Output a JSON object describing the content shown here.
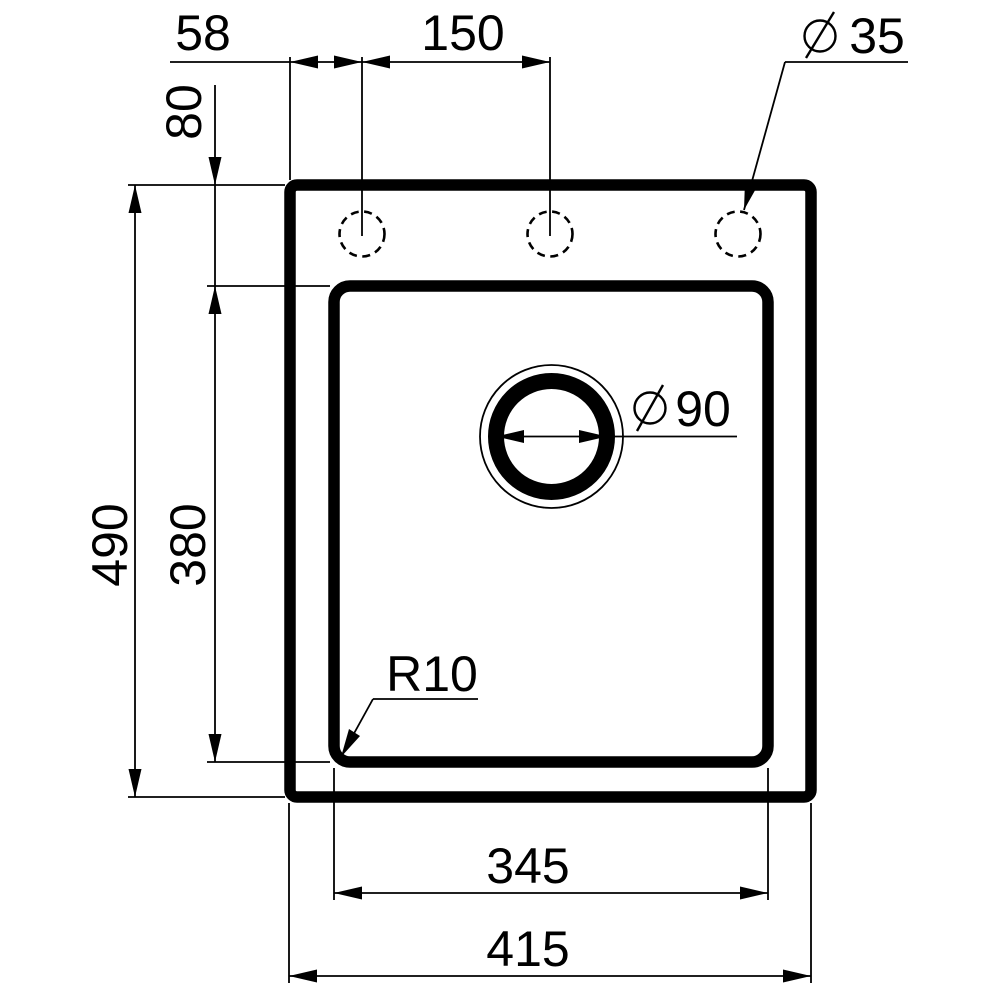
{
  "page": {
    "background": "#ffffff",
    "ink": "#000000",
    "description_labels_visible": [
      "58",
      "150",
      "35",
      "80",
      "90",
      "490",
      "380",
      "R10",
      "345",
      "415"
    ]
  },
  "labels": {
    "dim_58": "58",
    "dim_150": "150",
    "dia_35": "35",
    "dim_80": "80",
    "dia_90": "90",
    "dim_490": "490",
    "dim_380": "380",
    "radius_r10": "R10",
    "dim_345": "345",
    "dim_415": "415"
  },
  "dimensions": [
    {
      "value": 58,
      "type": "linear",
      "orientation": "horizontal",
      "measures": "rim left edge to first faucet hole center"
    },
    {
      "value": 150,
      "type": "linear",
      "orientation": "horizontal",
      "measures": "spacing between faucet hole centers"
    },
    {
      "value": 35,
      "type": "diameter",
      "orientation": "leader",
      "measures": "faucet hole diameter"
    },
    {
      "value": 80,
      "type": "linear",
      "orientation": "vertical",
      "measures": "rim top edge to bowl top edge"
    },
    {
      "value": 90,
      "type": "diameter",
      "orientation": "leader",
      "measures": "drain opening diameter"
    },
    {
      "value": 490,
      "type": "linear",
      "orientation": "vertical",
      "measures": "overall sink depth"
    },
    {
      "value": 380,
      "type": "linear",
      "orientation": "vertical",
      "measures": "bowl depth"
    },
    {
      "value": 10,
      "type": "radius",
      "orientation": "leader",
      "measures": "bowl corner radius",
      "label": "R10"
    },
    {
      "value": 345,
      "type": "linear",
      "orientation": "horizontal",
      "measures": "bowl width"
    },
    {
      "value": 415,
      "type": "linear",
      "orientation": "horizontal",
      "measures": "overall sink width"
    }
  ]
}
